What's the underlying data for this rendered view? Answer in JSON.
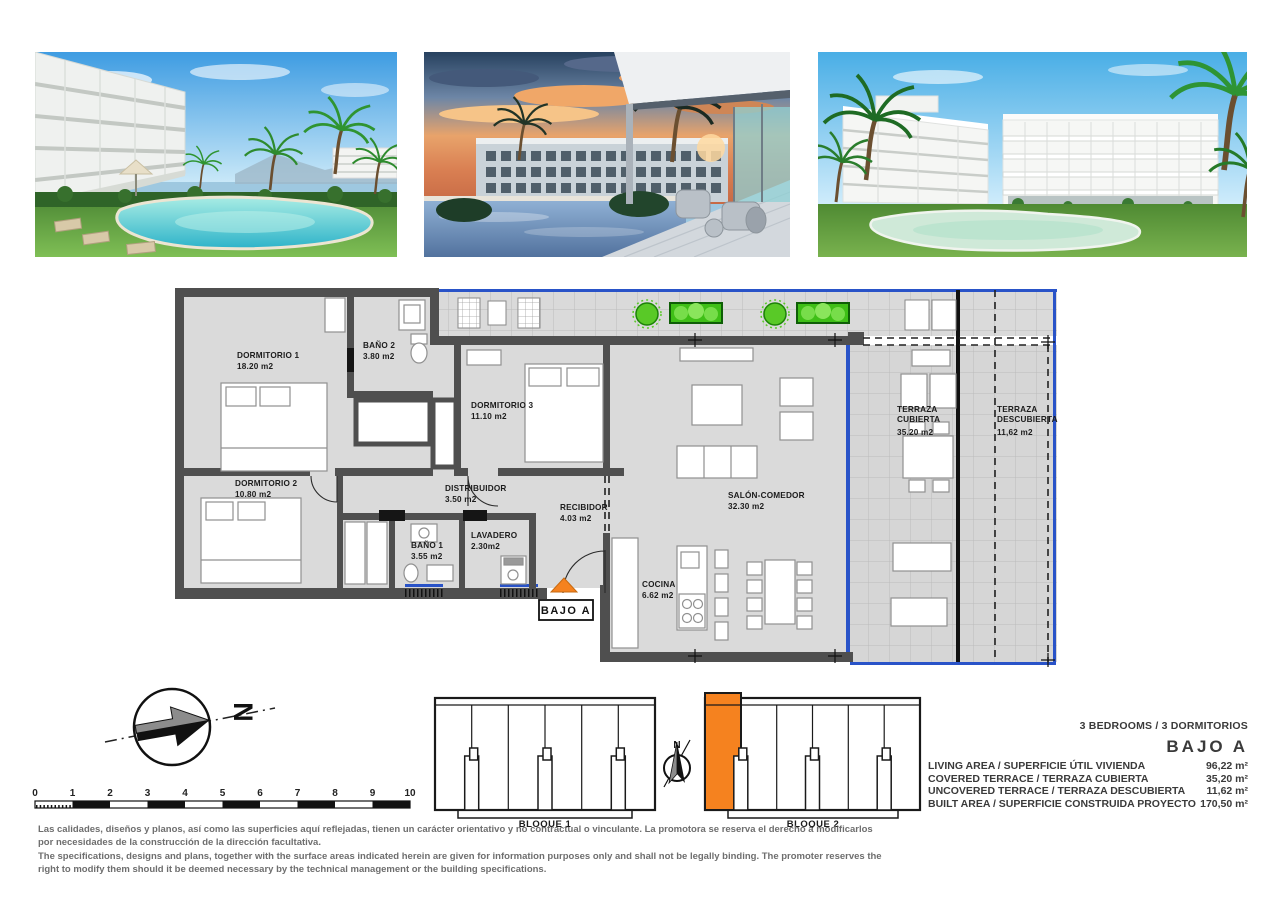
{
  "plan": {
    "rooms": {
      "dormitorio1": {
        "label": "DORMITORIO 1",
        "area": "18.20 m2"
      },
      "bano2": {
        "label": "BAÑO 2",
        "area": "3.80 m2"
      },
      "dormitorio3": {
        "label": "DORMITORIO 3",
        "area": "11.10 m2"
      },
      "dormitorio2": {
        "label": "DORMITORIO 2",
        "area": "10.80 m2"
      },
      "distribuidor": {
        "label": "DISTRIBUIDOR",
        "area": "3.50 m2"
      },
      "recibidor": {
        "label": "RECIBIDOR",
        "area": "4.03 m2"
      },
      "bano1": {
        "label": "BAÑO 1",
        "area": "3.55 m2"
      },
      "lavadero": {
        "label": "LAVADERO",
        "area": "2.30m2"
      },
      "salon": {
        "label": "SALÓN-COMEDOR",
        "area": "32.30 m2"
      },
      "cocina": {
        "label": "COCINA",
        "area": "6.62 m2"
      },
      "terraza_cubierta": {
        "l1": "TERRAZA",
        "l2": "CUBIERTA",
        "area": "35.20 m2"
      },
      "terraza_descubierta": {
        "l1": "TERRAZA",
        "l2": "DESCUBIERTA",
        "area": "11,62 m2"
      }
    },
    "unit_label": "BAJO A",
    "colors": {
      "highlight_orange": "#F5821F",
      "window_blue": "#2953c8",
      "wall_gray": "#4f4f4f"
    }
  },
  "compass": {
    "north": "N"
  },
  "scale": {
    "ticks": [
      "0",
      "1",
      "2",
      "3",
      "4",
      "5",
      "6",
      "7",
      "8",
      "9",
      "10"
    ]
  },
  "blocks": {
    "b1": "BLOQUE 1",
    "b2": "BLOQUE 2"
  },
  "summary": {
    "bedrooms": "3 BEDROOMS / 3 DORMITORIOS",
    "unit": "BAJO A",
    "rows": [
      {
        "label": "LIVING AREA / SUPERFICIE ÚTIL VIVIENDA",
        "value": "96,22 m²"
      },
      {
        "label": "COVERED TERRACE / TERRAZA CUBIERTA",
        "value": "35,20 m²"
      },
      {
        "label": "UNCOVERED TERRACE / TERRAZA DESCUBIERTA",
        "value": "11,62 m²"
      },
      {
        "label": "BUILT AREA / SUPERFICIE CONSTRUIDA PROYECTO",
        "value": "170,50 m²"
      }
    ]
  },
  "disclaimer": {
    "es": "Las calidades, diseños y planos, así como las superficies aquí reflejadas, tienen un carácter orientativo y no contractual o vinculante. La promotora se reserva el derecho a modificarlos por necesidades de la construcción de la dirección facultativa.",
    "en": "The specifications, designs and plans, together with the surface areas indicated herein are given for information purposes only and shall not be legally binding. The promoter reserves the right to modify them should it be deemed necessary by the technical management or the building specifications."
  }
}
